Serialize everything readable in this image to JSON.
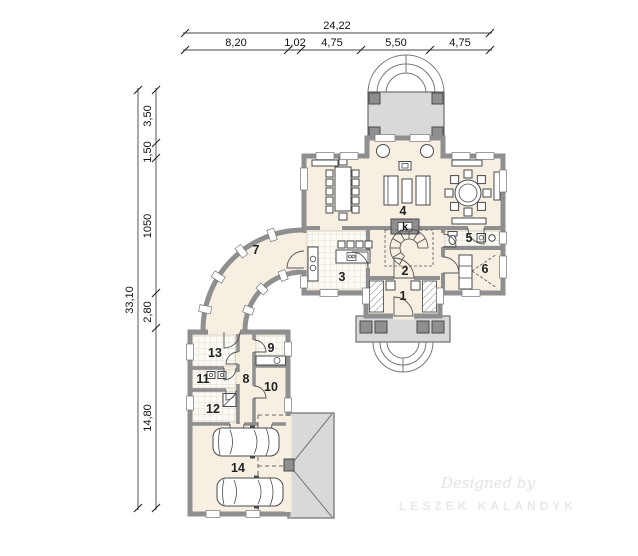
{
  "plan": {
    "dimensions": {
      "top_total": "24,22",
      "top_segments": [
        "8,20",
        "1,02",
        "4,75",
        "5,50",
        "4,75"
      ],
      "left_total": "33,10",
      "left_segments": [
        "3,50",
        "1,50",
        "1050",
        "2,80",
        "14,80"
      ]
    },
    "room_labels": {
      "r1": "1",
      "r2": "2",
      "r3": "3",
      "r4": "4",
      "r5": "5",
      "r6": "6",
      "r7": "7",
      "r8": "8",
      "r9": "9",
      "r10": "10",
      "r11": "11",
      "r12": "12",
      "r13": "13",
      "r14": "14",
      "fireplace": "k"
    },
    "watermark": {
      "line1": "Designed by",
      "line2": "LESZEK KALANDYK"
    },
    "colors": {
      "wall": "#8f8f8f",
      "floor": "#f6efe2",
      "paving": "#d9d9d9",
      "outline": "#4a4a4a",
      "dimension_text": "#111111"
    }
  }
}
